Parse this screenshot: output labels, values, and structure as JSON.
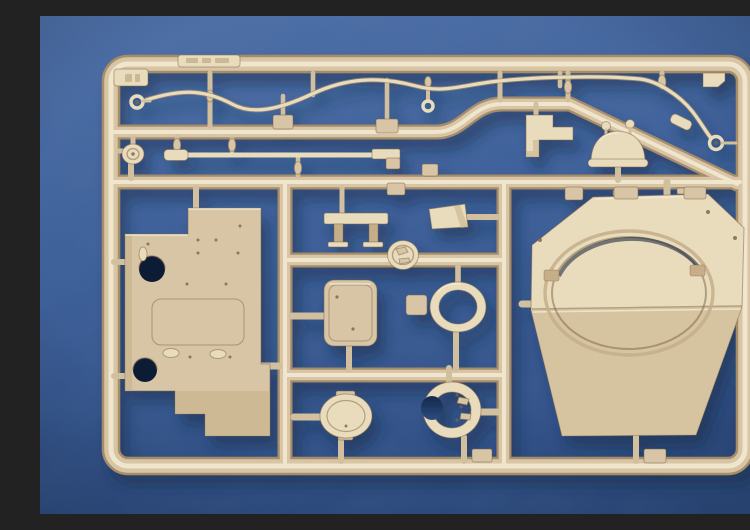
{
  "meta": {
    "title": "Model kit sprue photo",
    "description": "Photograph of a tan injection-molded plastic model kit sprue (parts tree) laid on mottled blue cloth. The rectangular runner frame holds a large octagonal turret roof with a big circular opening, a flat hull plate with holes and a rectangular cutout, a rounded rectangular door hatch, an oval hatch, two ring-shaped hatch collars, a long tow bar rod, a wavy tow cable with loop ends, a domed cupola, brackets, wedges and many small fittings attached by molding gates."
  },
  "colors": {
    "bg_top": "#4d6fa8",
    "bg_mid": "#3a5c97",
    "bg_bottom": "#2c4b82",
    "shadow": "#152847",
    "plastic": "#d8c5a5",
    "plastic_light": "#e9dcbc",
    "plastic_lighter": "#f6edd8",
    "plastic_mid": "#c6ae89",
    "plastic_dark": "#a78c68",
    "plastic_edge": "#7c6243",
    "stub": "#d2bf9e",
    "hole": "#101d36",
    "hole_top": "#17325c",
    "hole_bottom": "#365990",
    "cut_top": "#13294e",
    "cut_bottom": "#2d4b7d"
  },
  "parts": [
    "sprue runner frame",
    "tow cable with loop ends",
    "tow bar rod",
    "hull roof plate with cutouts",
    "turret roof with ring opening",
    "door hatch",
    "oval hatch",
    "hatch collar ring",
    "split collar ring",
    "dome cupola",
    "step bracket",
    "bench bracket",
    "wedge block",
    "cap disc",
    "pulley wheel",
    "small fitting blocks"
  ]
}
